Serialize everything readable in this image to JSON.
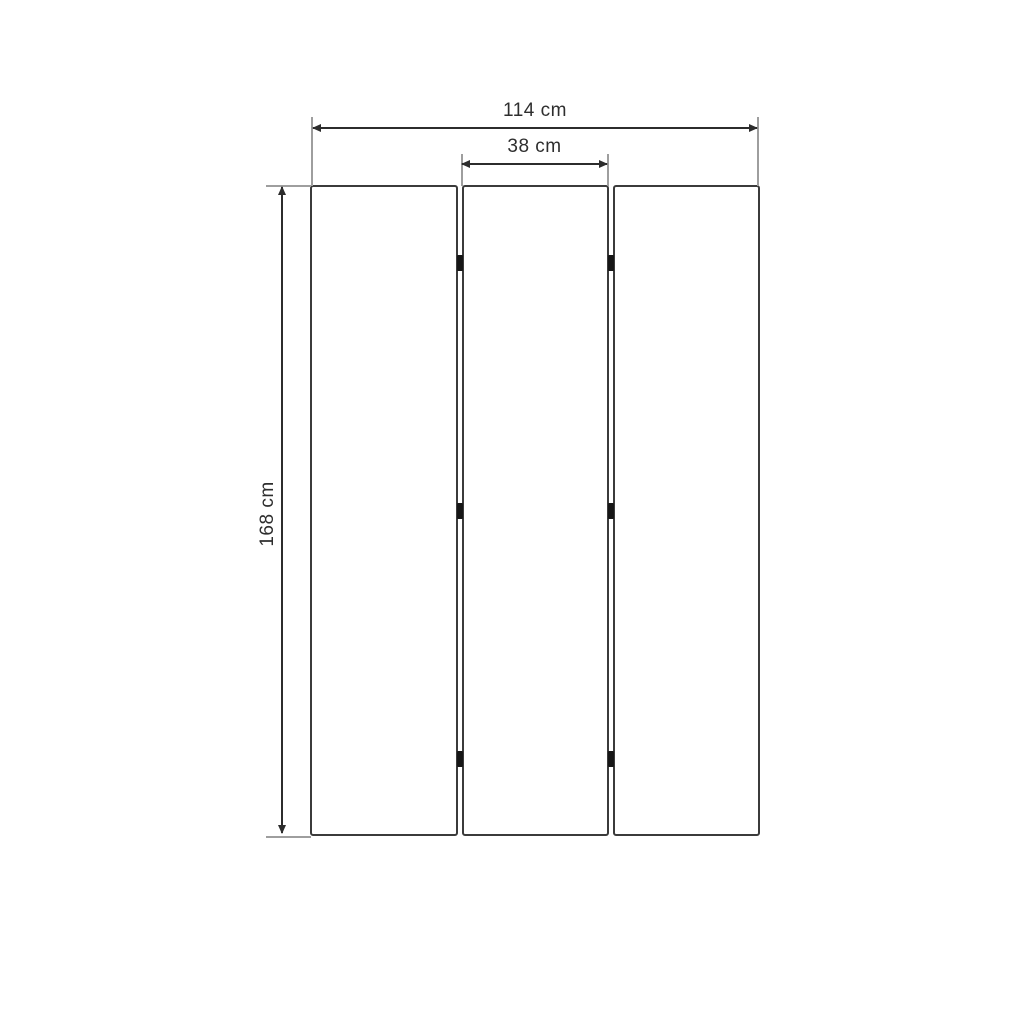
{
  "diagram": {
    "kind": "furniture-dimension-drawing",
    "panels_count": 3,
    "hinges_count": 6,
    "dims": {
      "width": {
        "label": "114 cm",
        "value": 114,
        "unit": "cm"
      },
      "panel": {
        "label": "38 cm",
        "value": 38,
        "unit": "cm"
      },
      "height": {
        "label": "168 cm",
        "value": 168,
        "unit": "cm"
      }
    },
    "colors": {
      "bg": "#ffffff",
      "line": "#2c2c2c",
      "ext": "#9e9e9e",
      "panel_border": "#3b3b3b",
      "hinge": "#161616",
      "text": "#2e2e2e"
    }
  }
}
